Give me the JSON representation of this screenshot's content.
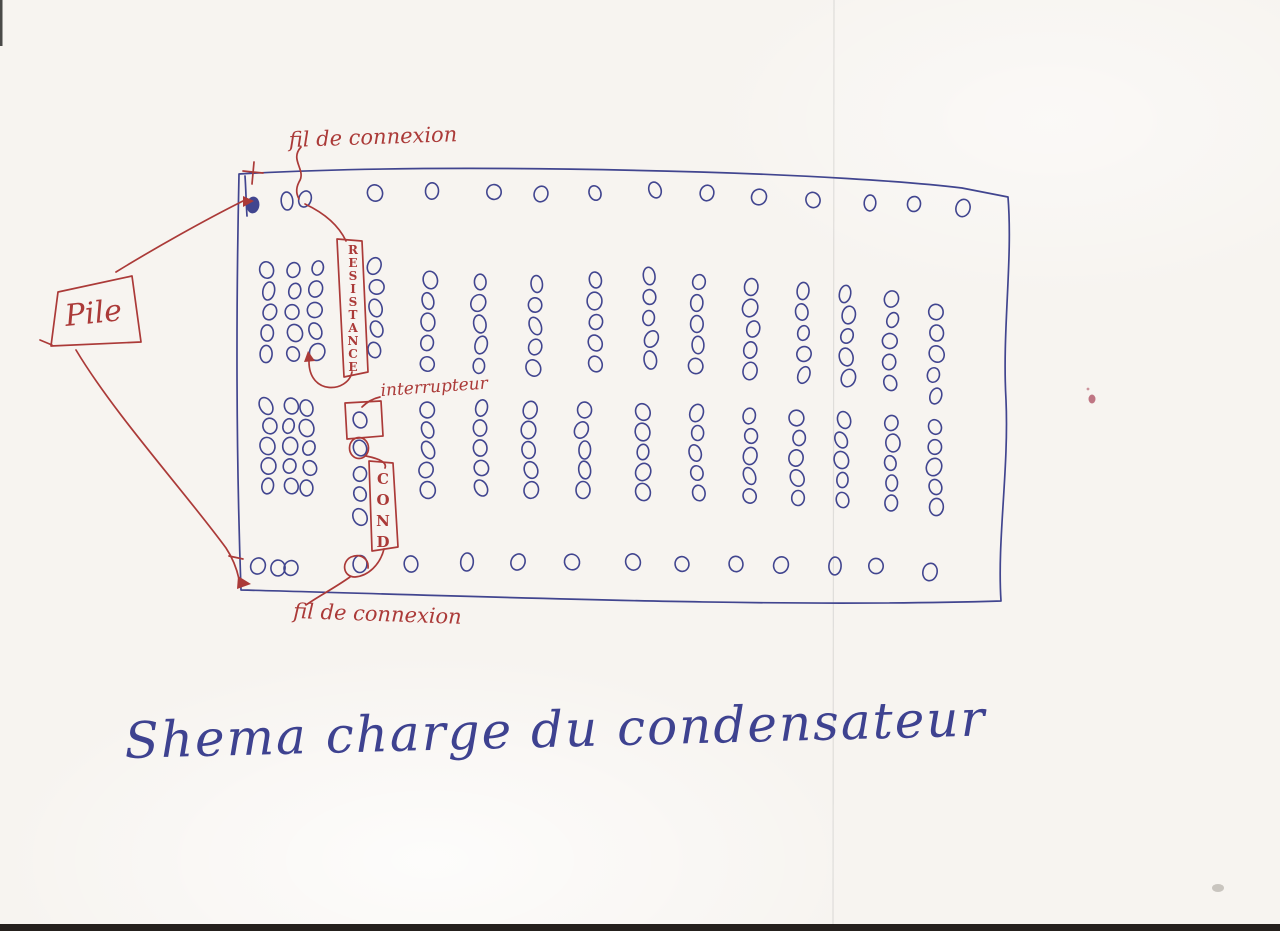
{
  "meta": {
    "paper_color": "#f7f4f0",
    "ink_blue": "#41458f",
    "ink_red": "#ab3a38",
    "caption_color": "#3e4290"
  },
  "labels": {
    "battery": "Pile",
    "plus_terminal": "+",
    "minus_terminal": "-",
    "top_wire": "fil de connexion",
    "bottom_wire": "fil de connexion",
    "resistor_vertical": "RESISTANCE",
    "switch": "interrupteur",
    "capacitor_vertical": "COND",
    "caption": "Shema charge du condensateur"
  },
  "board": {
    "top_row": {
      "first_hole_filled": true,
      "holes": [
        [
          253,
          205
        ],
        [
          287,
          201
        ],
        [
          305,
          199
        ],
        [
          375,
          193
        ],
        [
          432,
          191
        ],
        [
          494,
          192
        ],
        [
          541,
          194
        ],
        [
          595,
          193
        ],
        [
          655,
          190
        ],
        [
          707,
          193
        ],
        [
          759,
          197
        ],
        [
          813,
          200
        ],
        [
          870,
          203
        ],
        [
          914,
          204
        ],
        [
          963,
          208
        ]
      ]
    },
    "upper_block": {
      "holes_per_column": 5,
      "row_spacing": 21,
      "columns": [
        [
          268,
          270
        ],
        [
          293,
          270
        ],
        [
          316,
          268
        ],
        [
          376,
          266
        ],
        [
          429,
          280
        ],
        [
          480,
          282
        ],
        [
          535,
          284
        ],
        [
          596,
          280
        ],
        [
          650,
          276
        ],
        [
          697,
          282
        ],
        [
          752,
          287
        ],
        [
          803,
          291
        ],
        [
          847,
          294
        ],
        [
          891,
          299
        ],
        [
          935,
          312
        ]
      ]
    },
    "lower_block": {
      "holes_per_column": 5,
      "row_spacing": 20,
      "columns": [
        [
          268,
          406
        ],
        [
          290,
          406
        ],
        [
          308,
          408
        ],
        [
          427,
          410
        ],
        [
          480,
          408
        ],
        [
          530,
          410
        ],
        [
          583,
          410
        ],
        [
          644,
          412
        ],
        [
          697,
          413
        ],
        [
          750,
          416
        ],
        [
          798,
          418
        ],
        [
          843,
          420
        ],
        [
          891,
          423
        ],
        [
          935,
          427
        ]
      ]
    },
    "switch_column": {
      "x": 360,
      "holes_y": [
        420,
        448,
        474,
        494,
        517
      ]
    },
    "bottom_row": {
      "holes": [
        [
          258,
          566
        ],
        [
          278,
          568
        ],
        [
          291,
          568
        ],
        [
          360,
          564
        ],
        [
          411,
          564
        ],
        [
          467,
          562
        ],
        [
          518,
          562
        ],
        [
          572,
          562
        ],
        [
          633,
          562
        ],
        [
          682,
          564
        ],
        [
          736,
          564
        ],
        [
          781,
          565
        ],
        [
          835,
          566
        ],
        [
          876,
          566
        ],
        [
          930,
          572
        ]
      ]
    }
  }
}
